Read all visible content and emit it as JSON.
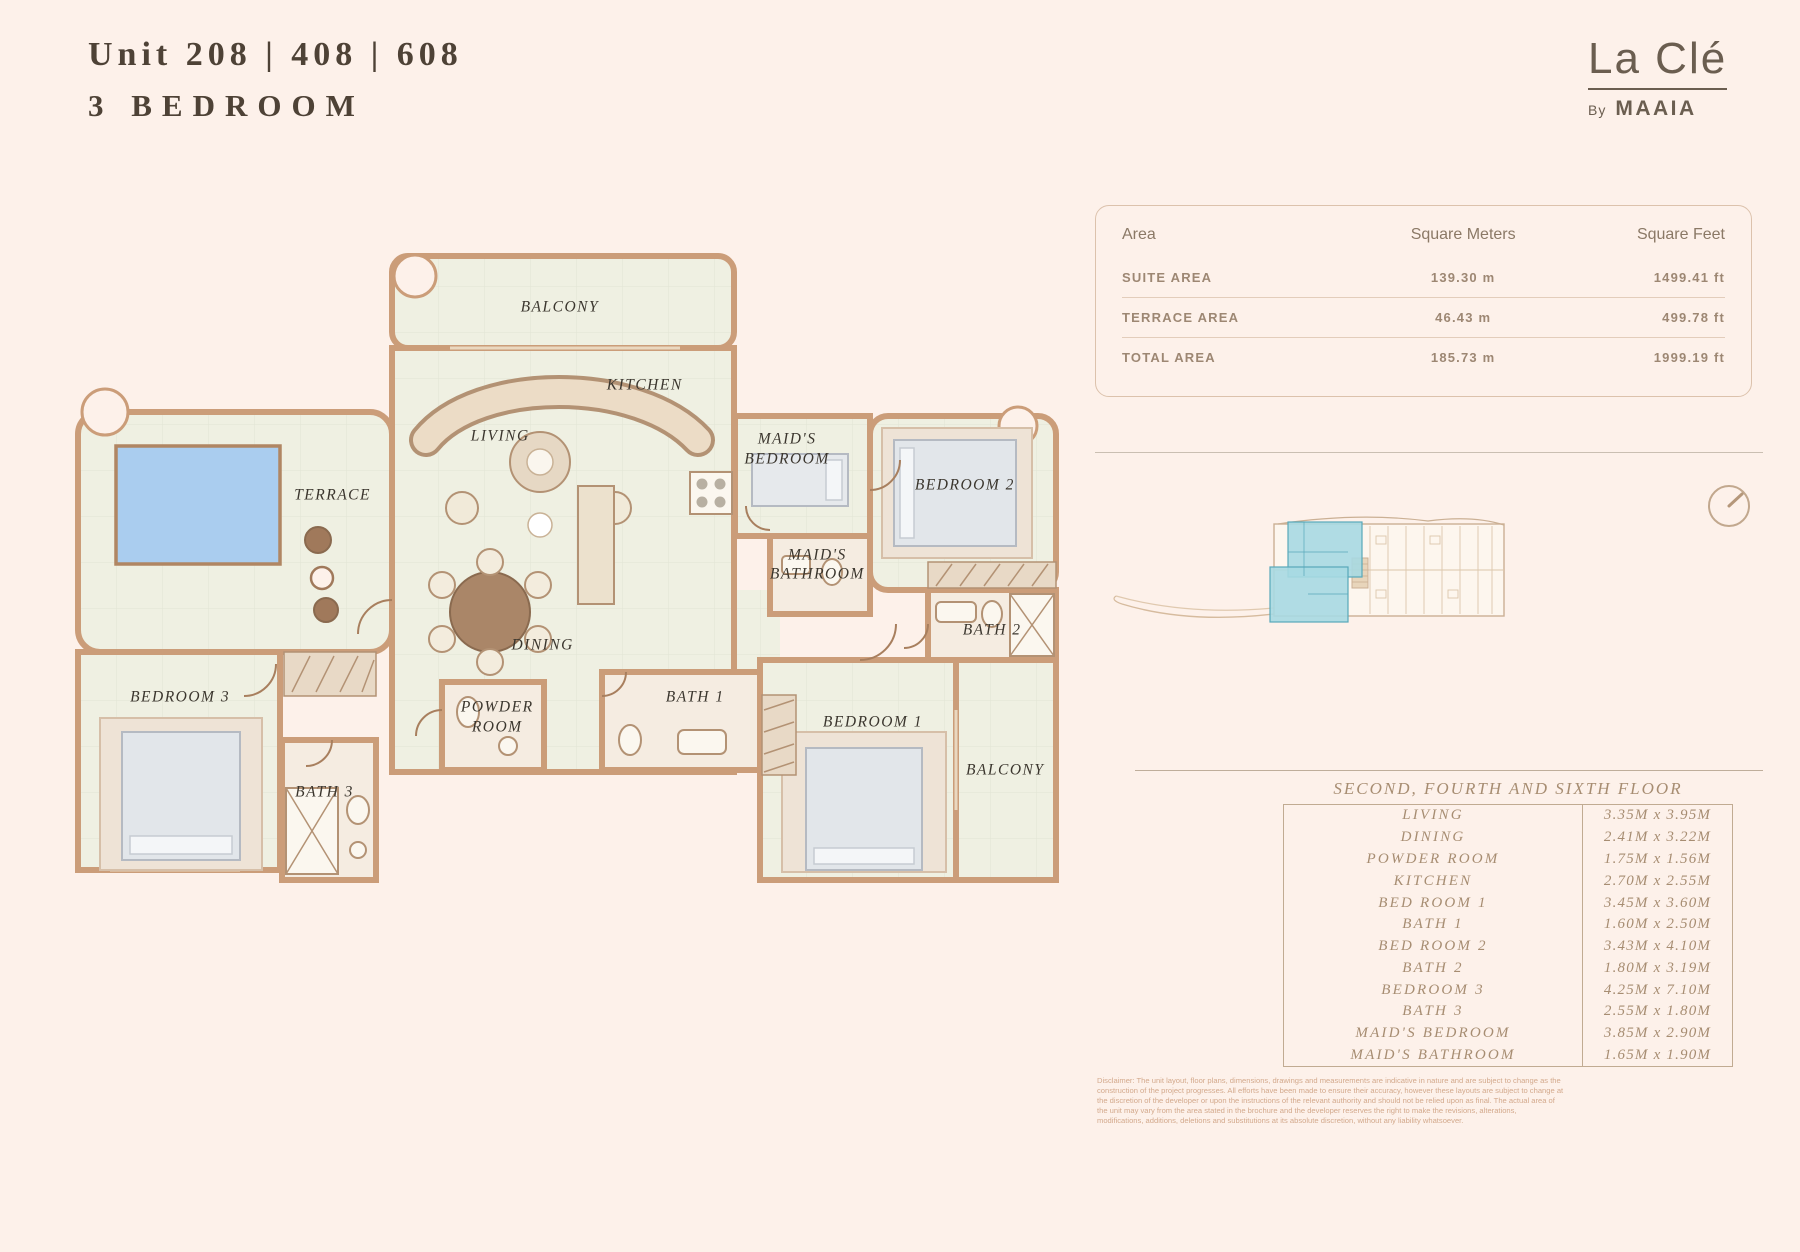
{
  "header": {
    "title_line1": "Unit 208 | 408 | 608",
    "title_line2": "3 BEDROOM"
  },
  "brand": {
    "name": "La Clé",
    "by": "By",
    "company": "MAAIA"
  },
  "area_table": {
    "headers": [
      "Area",
      "Square Meters",
      "Square Feet"
    ],
    "rows": [
      {
        "label": "SUITE AREA",
        "sqm": "139.30 m",
        "sqft": "1499.41 ft"
      },
      {
        "label": "TERRACE AREA",
        "sqm": "46.43 m",
        "sqft": "499.78 ft"
      },
      {
        "label": "TOTAL AREA",
        "sqm": "185.73 m",
        "sqft": "1999.19 ft"
      }
    ]
  },
  "dimensions": {
    "title": "SECOND, FOURTH AND SIXTH FLOOR",
    "rows": [
      {
        "room": "LIVING",
        "size": "3.35M x 3.95M"
      },
      {
        "room": "DINING",
        "size": "2.41M x 3.22M"
      },
      {
        "room": "POWDER ROOM",
        "size": "1.75M x 1.56M"
      },
      {
        "room": "KITCHEN",
        "size": "2.70M x 2.55M"
      },
      {
        "room": "BED ROOM 1",
        "size": "3.45M x 3.60M"
      },
      {
        "room": "BATH 1",
        "size": "1.60M x 2.50M"
      },
      {
        "room": "BED ROOM 2",
        "size": "3.43M x 4.10M"
      },
      {
        "room": "BATH 2",
        "size": "1.80M x 3.19M"
      },
      {
        "room": "BEDROOM 3",
        "size": "4.25M x 7.10M"
      },
      {
        "room": "BATH 3",
        "size": "2.55M x 1.80M"
      },
      {
        "room": "MAID'S BEDROOM",
        "size": "3.85M x 2.90M"
      },
      {
        "room": "MAID'S BATHROOM",
        "size": "1.65M x 1.90M"
      }
    ]
  },
  "plan": {
    "rooms": {
      "balcony_top": "BALCONY",
      "kitchen": "KITCHEN",
      "living": "LIVING",
      "maids_bedroom": "MAID'S BEDROOM",
      "bedroom2": "BEDROOM 2",
      "terrace": "TERRACE",
      "maids_bathroom": "MAID'S BATHROOM",
      "bath2": "BATH 2",
      "dining": "DINING",
      "bedroom3": "BEDROOM 3",
      "powder_room": "POWDER ROOM",
      "bath1": "BATH 1",
      "bedroom1": "BEDROOM 1",
      "balcony_right": "BALCONY",
      "bath3": "BATH 3"
    }
  },
  "colors": {
    "background": "#fdf1ea",
    "wall": "#cb9d79",
    "floor": "#eff0e2",
    "pool": "#aacdef",
    "keyplan_highlight": "#a7d9e2",
    "text_brown": "#4e4236",
    "table_taupe": "#a78d72"
  },
  "disclaimer": "Disclaimer: The unit layout, floor plans, dimensions, drawings and measurements are indicative in nature and are subject to change as the construction of the project progresses. All efforts have been made to ensure their accuracy, however these layouts are subject to change at the discretion of the developer or upon the instructions of the relevant authority and should not be relied upon as final. The actual area of the unit may vary from the area stated in the brochure and the developer reserves the right to make the revisions, alterations, modifications, additions, deletions and substitutions at its absolute discretion, without any liability whatsoever."
}
